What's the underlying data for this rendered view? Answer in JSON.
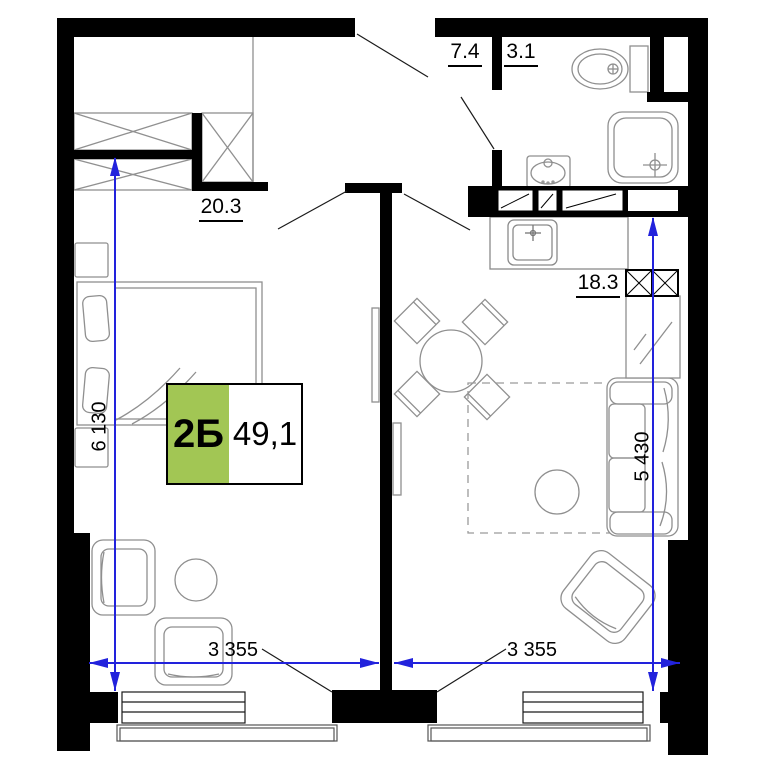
{
  "plan": {
    "title": "apartment-floor-plan",
    "unit_badge": {
      "unit": "2Б",
      "area": "49,1"
    },
    "rooms": {
      "bedroom": {
        "area": "20.3"
      },
      "hall": {
        "area": "7.4"
      },
      "bathroom": {
        "area": "3.1"
      },
      "living_kitchen": {
        "area": "18.3"
      }
    },
    "dimensions": {
      "bedroom_height": "6 130",
      "living_height": "5 430",
      "bedroom_width": "3 355",
      "living_width": "3 355"
    },
    "colors": {
      "wall": "#000000",
      "dimension_blue": "#2222dc",
      "badge_green": "#a2c654",
      "furniture_line": "#8f8f8f"
    }
  }
}
